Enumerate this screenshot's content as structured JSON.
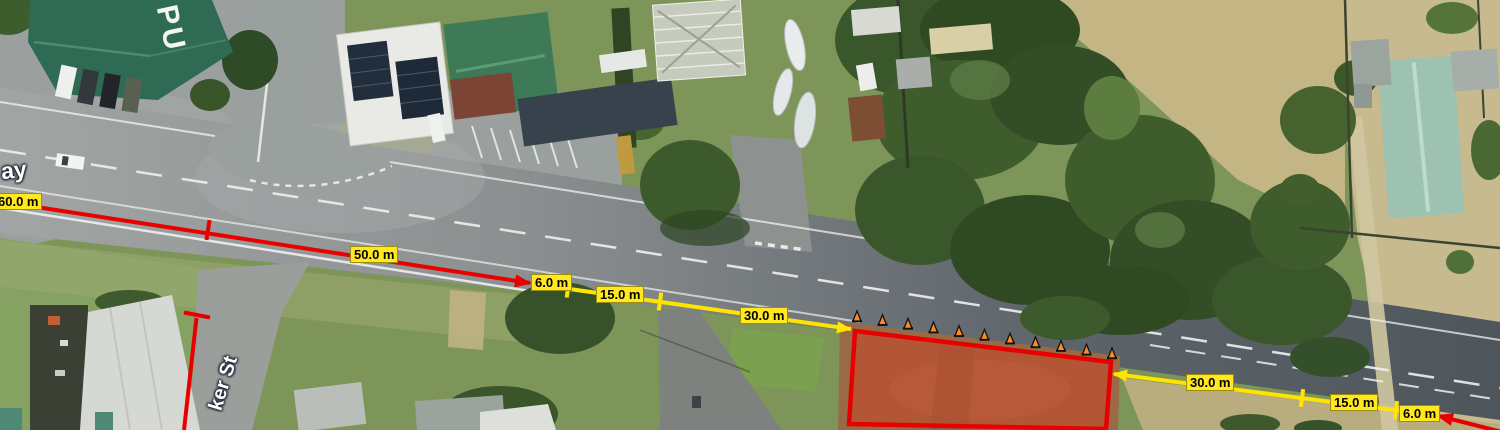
{
  "view": {
    "type": "aerial-imagery-with-traffic-plan",
    "width_px": 1500,
    "height_px": 430
  },
  "map_labels": {
    "road_name_fragment": "ay",
    "street_name_fragment": "ker St",
    "building_roof_text": "PU"
  },
  "measurements": {
    "unit": "m",
    "left_chain": [
      "60.0 m",
      "50.0 m",
      "6.0 m",
      "15.0 m",
      "30.0 m"
    ],
    "right_chain": [
      "30.0 m",
      "15.0 m",
      "6.0 m"
    ]
  },
  "work_zone": {
    "cone_count": 11,
    "outline_color": "#e60000",
    "fill_color": "rgba(226,48,22,0.35)"
  },
  "colors": {
    "measure_red": "#e80000",
    "measure_yellow": "#ffe400",
    "label_bg": "#ffe81e",
    "label_border": "#9c8c10",
    "label_text": "#000000",
    "cone_orange": "#ff8a1e",
    "pub_roof": "#2f6b54",
    "right_house_roof": "#9dc2b1"
  }
}
